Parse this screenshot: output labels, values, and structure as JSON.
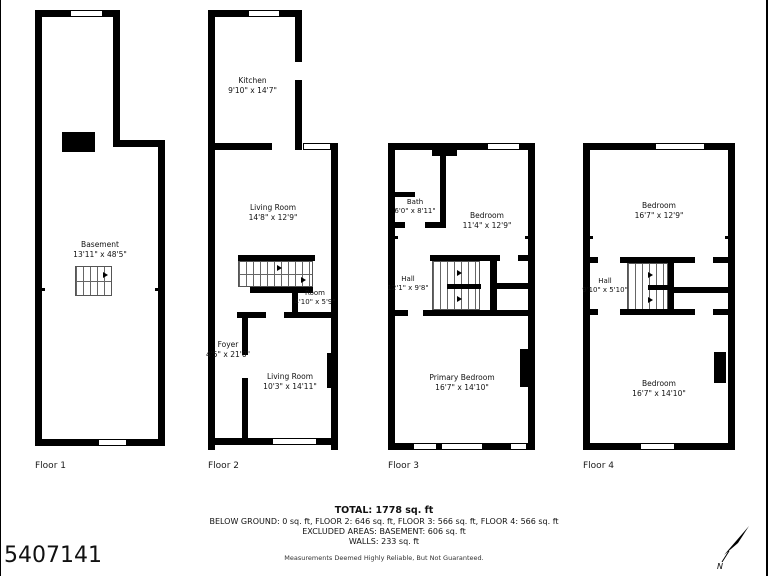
{
  "photo_id": "5407141",
  "compass": {
    "label": "N"
  },
  "floors": [
    {
      "label": "Floor 1",
      "rooms": [
        {
          "name": "Basement",
          "dims": "13'11\" x 48'5\""
        }
      ]
    },
    {
      "label": "Floor 2",
      "rooms": [
        {
          "name": "Kitchen",
          "dims": "9'10\" x 14'7\""
        },
        {
          "name": "Living Room",
          "dims": "14'8\" x 12'9\""
        },
        {
          "name": "Room",
          "dims": "4'10\" x 5'9\""
        },
        {
          "name": "Foyer",
          "dims": "4'5\" x 21'0\""
        },
        {
          "name": "Living Room",
          "dims": "10'3\" x 14'11\""
        }
      ]
    },
    {
      "label": "Floor 3",
      "rooms": [
        {
          "name": "Bath",
          "dims": "6'0\" x 8'11\""
        },
        {
          "name": "Bedroom",
          "dims": "11'4\" x 12'9\""
        },
        {
          "name": "Hall",
          "dims": "12'1\" x 9'8\""
        },
        {
          "name": "Primary Bedroom",
          "dims": "16'7\" x 14'10\""
        }
      ]
    },
    {
      "label": "Floor 4",
      "rooms": [
        {
          "name": "Bedroom",
          "dims": "16'7\" x 12'9\""
        },
        {
          "name": "Hall",
          "dims": "9'10\" x 5'10\""
        },
        {
          "name": "Bedroom",
          "dims": "16'7\" x 14'10\""
        }
      ]
    }
  ],
  "summary": {
    "total": "TOTAL: 1778 sq. ft",
    "floor_areas": "BELOW GROUND: 0 sq. ft, FLOOR 2: 646 sq. ft, FLOOR 3: 566 sq. ft, FLOOR 4: 566 sq. ft",
    "excluded": "EXCLUDED AREAS: BASEMENT: 606 sq. ft",
    "walls": "WALLS: 233 sq. ft",
    "disclaimer": "Measurements Deemed Highly Reliable, But Not Guaranteed."
  }
}
